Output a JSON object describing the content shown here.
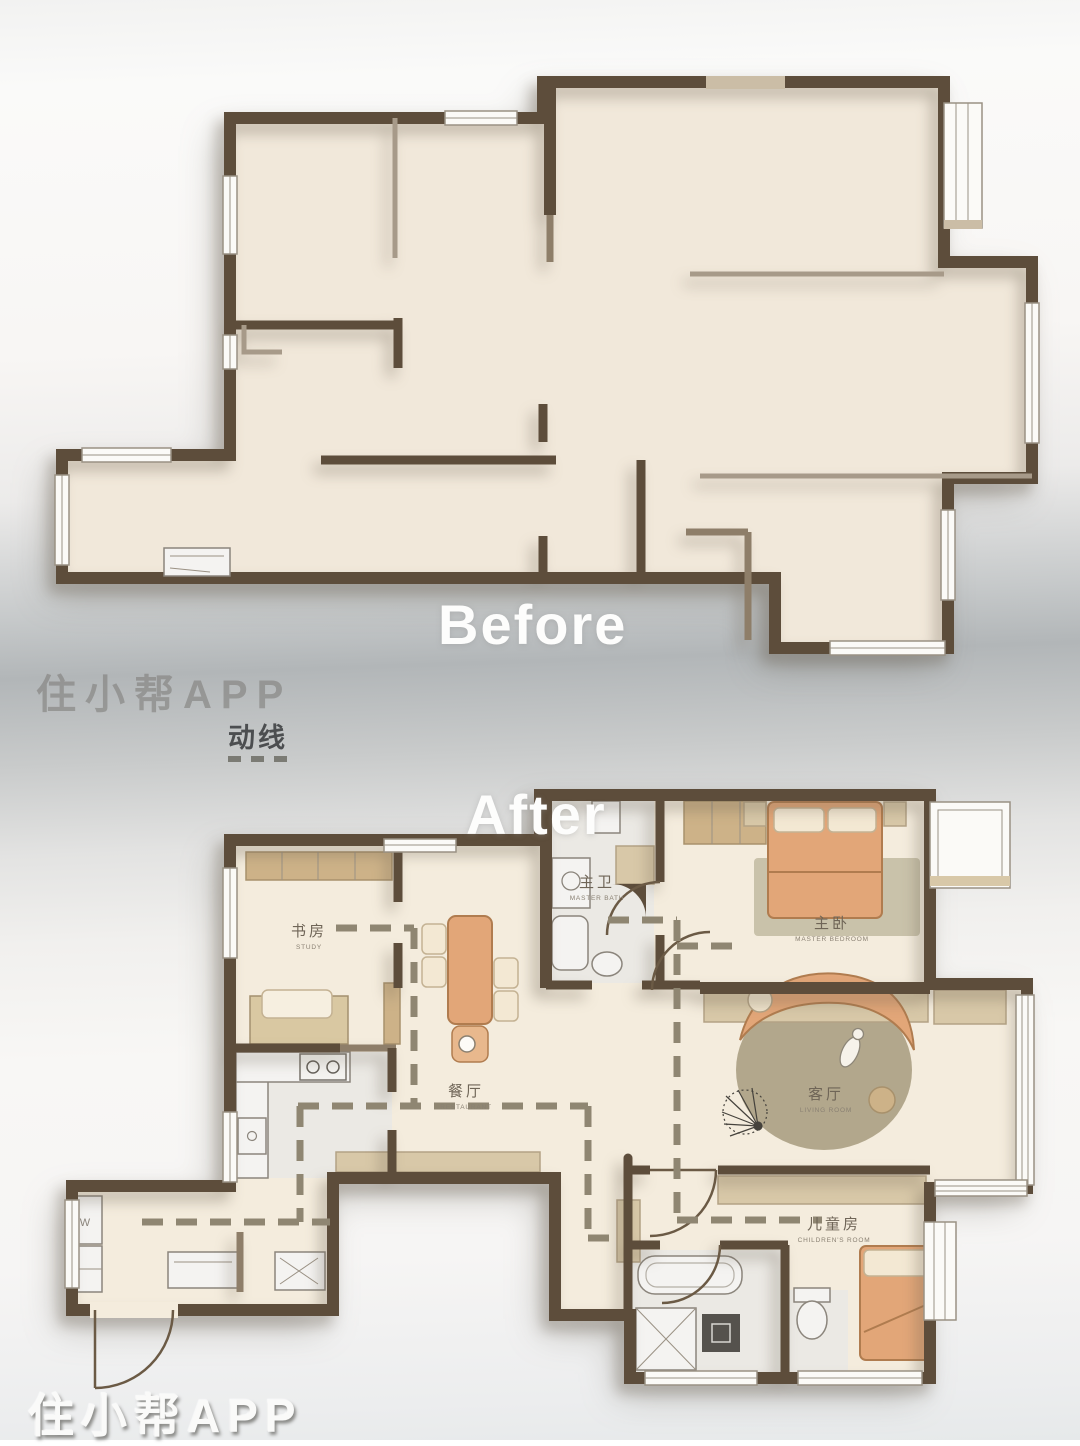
{
  "titles": {
    "before": "Before",
    "after": "After"
  },
  "watermark": {
    "top": "住小帮APP",
    "bottom": "住小帮APP"
  },
  "flow_label": "动线",
  "rooms": {
    "study": {
      "cn": "书房",
      "en": "STUDY"
    },
    "master_bath": {
      "cn": "主卫",
      "en": "MASTER BATH"
    },
    "master_bedroom": {
      "cn": "主卧",
      "en": "MASTER BEDROOM"
    },
    "dining": {
      "cn": "餐厅",
      "en": "RESTAURANT"
    },
    "living": {
      "cn": "客厅",
      "en": "LIVING ROOM"
    },
    "children": {
      "cn": "儿童房",
      "en": "CHILDREN'S ROOM"
    }
  },
  "labels": {
    "washer": "W"
  },
  "colors": {
    "wall": "#5d4d3b",
    "wall_light": "#8e7e69",
    "floor_before": "#f1e8da",
    "floor_after": "#f4ecdd",
    "furniture_orange": "#e2a678",
    "furniture_tan": "#cdb288",
    "flow_dash": "#8f8672"
  }
}
